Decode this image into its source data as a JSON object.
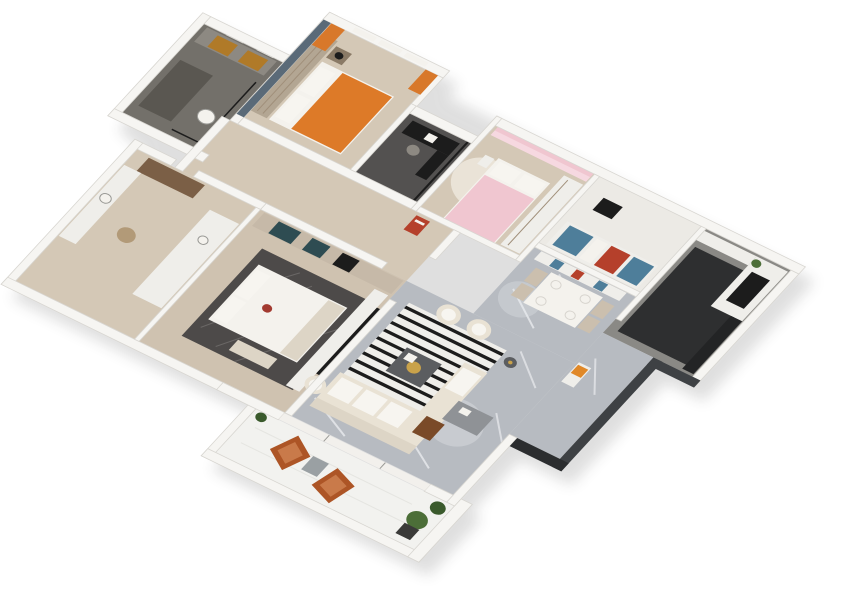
{
  "meta": {
    "description": "3D axonometric rendering of a residential apartment floor plan viewed from above at an angle on a white background",
    "background": "#ffffff",
    "view": "top-down axonometric, plan rotated clockwise about 26 degrees"
  },
  "palette": {
    "wall": "#f6f5f2",
    "wallEdge": "#d8d6d1",
    "marble": "#b7bbc1",
    "marbleVein": "#e9ebee",
    "wood": "#d4c8b6",
    "woodDark": "#cfc2b0",
    "darkFloor": "#73706a",
    "studyFloor": "#535150",
    "kidsFloor": "#eceae5",
    "kitchenFloor": "#8a8985",
    "kitchenDark": "#2e2f30",
    "balconyFloor": "#f2f2ef",
    "white": "#f4f2ed",
    "whiteFurn": "#efeeea",
    "pillow": "#f7f5f0",
    "cream": "#e9e2d4",
    "creamDark": "#ddd5c6",
    "orange": "#dd7a28",
    "curtainOrange": "#d8782a",
    "rust": "#ad5526",
    "rustLight": "#c97a4a",
    "pink": "#f0c6d0",
    "pinkLight": "#f6d8e0",
    "blue": "#4e7e9a",
    "red": "#b5402b",
    "blueWall": "#5a6a78",
    "teal": "#2e4c52",
    "amber": "#b07a28",
    "brown": "#7b5f46",
    "woodChair": "#7a4a28",
    "beigeChair": "#cbbfae",
    "gold": "#c9a24a",
    "black": "#1c1c1c",
    "darkGray": "#3e4144",
    "darkerGray": "#2b2d2f",
    "rugDark": "#4d4a49",
    "rugLine": "#7e7c7a",
    "rugWhite": "#efeeea",
    "rugCream": "#eae3d7",
    "green": "#4c6e38",
    "greenDark": "#3a5a2c",
    "potDark": "#3a3a38",
    "gray": "#9aa0a3",
    "tableGray": "#5b5d60",
    "grayCounter": "#8d8982",
    "darkMat": "#5a5751",
    "wardrobe": "#b3a693",
    "wardrobe2": "#c6b9a8",
    "wardrobeLine": "#a08f7a",
    "nightstandWood": "#8a7a66",
    "woven": "#b29a78",
    "redCushion": "#a23a30",
    "cabinetDark": "#232425",
    "deskGray": "#8f9296",
    "orangeDecor": "#e08828",
    "shadowFill": "#222222",
    "glassFrame": "#9a9a96",
    "plateEdge": "#d8d5cf",
    "hexLine": "#e3e3df"
  },
  "layers": [
    "shadow",
    "bathroom-1",
    "bedroom-2",
    "study-nook",
    "hallway",
    "bedroom-3",
    "kids-room",
    "dining-area",
    "kitchen",
    "bathroom-2",
    "master-bedroom",
    "living-room",
    "entry-hall",
    "balcony",
    "walls",
    "exterior-walls",
    "overlays"
  ],
  "rooms": [
    {
      "id": "bathroom-1",
      "name": "Bathroom 1",
      "floor": "dark gray tile",
      "furniture": [
        "double vanity",
        "amber cabinets",
        "mirrors",
        "glass shower",
        "dark floor mat",
        "toilet"
      ]
    },
    {
      "id": "bedroom-2",
      "name": "Bedroom with orange bed",
      "floor": "light wood",
      "furniture": [
        "wardrobe",
        "double bed with orange duvet",
        "white pillows",
        "nightstand",
        "black table lamp",
        "windows with orange curtains",
        "blue-gray accent wall"
      ]
    },
    {
      "id": "study-nook",
      "name": "Study nook",
      "floor": "dark gray",
      "furniture": [
        "black desk",
        "desk chair",
        "glass partition"
      ]
    },
    {
      "id": "hallway",
      "name": "Hallway",
      "floor": "light wood",
      "furniture": [
        "red wall artwork"
      ]
    },
    {
      "id": "bedroom-3",
      "name": "Pink bedroom",
      "floor": "light wood",
      "furniture": [
        "pink curtains",
        "bed with pink duvet",
        "white pillows",
        "round cream rug",
        "white wardrobe",
        "nightstand"
      ]
    },
    {
      "id": "kids-room",
      "name": "Kids room",
      "floor": "white",
      "furniture": [
        "daybed with blue and red cushions",
        "black desk"
      ]
    },
    {
      "id": "dining-area",
      "name": "Dining area",
      "floor": "gray marble",
      "furniture": [
        "sideboard with blue and red decor",
        "white dining table",
        "four beige chairs",
        "place settings"
      ]
    },
    {
      "id": "kitchen",
      "name": "Kitchen",
      "floor": "gray with dark zone",
      "furniture": [
        "white counter with black cooktop",
        "potted plant",
        "dark island",
        "dark tall cabinets"
      ]
    },
    {
      "id": "bathroom-2",
      "name": "Bathroom 2 / dressing",
      "floor": "light wood",
      "furniture": [
        "brown cabinet",
        "vanity counter with sink",
        "woven stool",
        "white counter with basin"
      ]
    },
    {
      "id": "master-bedroom",
      "name": "Master bedroom",
      "floor": "light wood",
      "furniture": [
        "wardrobe with teal doors",
        "dark patterned rug",
        "double bed with white duvet",
        "pillows",
        "red accent cushion",
        "TV console",
        "wall TV",
        "foot bench"
      ]
    },
    {
      "id": "living-room",
      "name": "Living room",
      "floor": "gray marble",
      "furniture": [
        "black and white striped rug",
        "two cream armchairs",
        "extra cream armchair",
        "L-shaped cream sofa",
        "dark coffee table with gold tray",
        "round side table",
        "gray desk",
        "brown leather chair"
      ]
    },
    {
      "id": "entry-hall",
      "name": "Entry hall",
      "floor": "gray marble",
      "furniture": [
        "console with orange decor"
      ]
    },
    {
      "id": "balcony",
      "name": "Balcony",
      "floor": "white tile",
      "furniture": [
        "two rust lounge chairs",
        "gray cube side table",
        "potted plants"
      ]
    }
  ]
}
